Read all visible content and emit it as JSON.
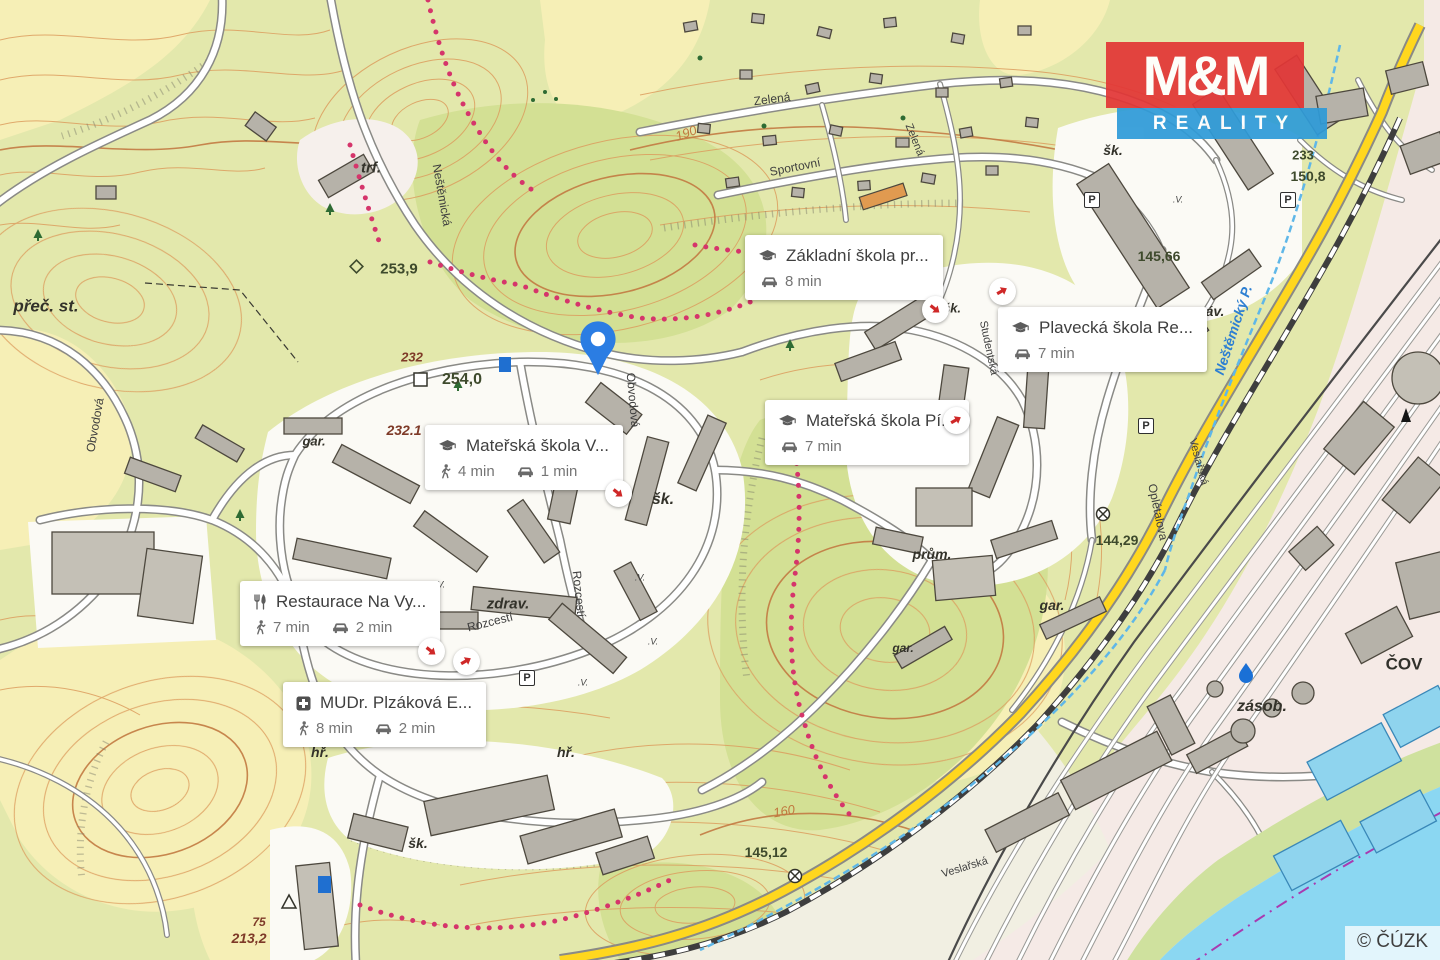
{
  "logo": {
    "title": "M&M",
    "subtitle": "REALITY"
  },
  "attribution": "© ČÚZK",
  "colors": {
    "pin": "#2b7de3",
    "logo_red": "#e23636",
    "logo_blue": "#2f9bd8",
    "route_arrow": "#cf2828",
    "water": "#8bd7f2",
    "main_road": "#ffd71e"
  },
  "pois": [
    {
      "id": "zakladni-skola",
      "icon": "graduation-cap-icon",
      "title": "Základní škola pr...",
      "drive": "8 min"
    },
    {
      "id": "plavecka-skola",
      "icon": "graduation-cap-icon",
      "title": "Plavecká škola Re...",
      "drive": "7 min"
    },
    {
      "id": "materska-skola-pi",
      "icon": "graduation-cap-icon",
      "title": "Mateřská škola Pí...",
      "drive": "7 min"
    },
    {
      "id": "materska-skola-v",
      "icon": "graduation-cap-icon",
      "title": "Mateřská škola V...",
      "walk": "4 min",
      "drive": "1 min"
    },
    {
      "id": "restaurace-na-vy",
      "icon": "restaurant-icon",
      "title": "Restaurace Na Vy...",
      "walk": "7 min",
      "drive": "2 min"
    },
    {
      "id": "mudr-plzakova",
      "icon": "medical-cross-icon",
      "title": "MUDr. Plzáková E...",
      "walk": "8 min",
      "drive": "2 min"
    }
  ],
  "route_arrows": [
    {
      "x": 935,
      "y": 309,
      "dir": "se"
    },
    {
      "x": 1002,
      "y": 291,
      "dir": "ne"
    },
    {
      "x": 956,
      "y": 420,
      "dir": "ne"
    },
    {
      "x": 618,
      "y": 493,
      "dir": "se"
    },
    {
      "x": 431,
      "y": 651,
      "dir": "se"
    },
    {
      "x": 466,
      "y": 661,
      "dir": "ne"
    }
  ],
  "map_labels": [
    {
      "text": "přeč. st.",
      "x": 46,
      "y": 306,
      "fs": 17,
      "cls": "spot",
      "rot": 0
    },
    {
      "text": "trf.",
      "x": 371,
      "y": 168,
      "fs": 15,
      "cls": "spot",
      "rot": 0
    },
    {
      "text": "253,9",
      "x": 399,
      "y": 269,
      "fs": 15,
      "cls": "height",
      "rot": 0
    },
    {
      "text": "232",
      "x": 412,
      "y": 357,
      "fs": 13,
      "cls": "heightred",
      "rot": 0
    },
    {
      "text": "254,0",
      "x": 462,
      "y": 380,
      "fs": 16,
      "cls": "height",
      "rot": 0
    },
    {
      "text": "232.1",
      "x": 404,
      "y": 430,
      "fs": 14,
      "cls": "heightred",
      "rot": 0
    },
    {
      "text": "gar.",
      "x": 314,
      "y": 441,
      "fs": 13,
      "cls": "spot",
      "rot": 0
    },
    {
      "text": "zdrav.",
      "x": 508,
      "y": 604,
      "fs": 15,
      "cls": "spot",
      "rot": 0
    },
    {
      "text": "šk.",
      "x": 663,
      "y": 500,
      "fs": 16,
      "cls": "spot",
      "rot": 0
    },
    {
      "text": "šk.",
      "x": 952,
      "y": 308,
      "fs": 13,
      "cls": "spot",
      "rot": 0
    },
    {
      "text": "šk.",
      "x": 1113,
      "y": 150,
      "fs": 14,
      "cls": "spot",
      "rot": 0
    },
    {
      "text": "šk.",
      "x": 418,
      "y": 843,
      "fs": 14,
      "cls": "spot",
      "rot": 0
    },
    {
      "text": "hř.",
      "x": 320,
      "y": 752,
      "fs": 14,
      "cls": "spot",
      "rot": 0
    },
    {
      "text": "hř.",
      "x": 566,
      "y": 752,
      "fs": 14,
      "cls": "spot",
      "rot": 0
    },
    {
      "text": "gar.",
      "x": 1052,
      "y": 605,
      "fs": 14,
      "cls": "spot",
      "rot": 0
    },
    {
      "text": "gar.",
      "x": 903,
      "y": 648,
      "fs": 12,
      "cls": "spot",
      "rot": 0
    },
    {
      "text": "prům.",
      "x": 932,
      "y": 554,
      "fs": 14,
      "cls": "spot",
      "rot": 0
    },
    {
      "text": "ČOV",
      "x": 1404,
      "y": 664,
      "fs": 17,
      "cls": "big",
      "rot": 0
    },
    {
      "text": "zásob.",
      "x": 1262,
      "y": 707,
      "fs": 16,
      "cls": "spot",
      "rot": 0
    },
    {
      "text": "145,66",
      "x": 1159,
      "y": 256,
      "fs": 14,
      "cls": "height",
      "rot": 0
    },
    {
      "text": "233",
      "x": 1303,
      "y": 155,
      "fs": 13,
      "cls": "height",
      "rot": 0
    },
    {
      "text": "150,8",
      "x": 1308,
      "y": 176,
      "fs": 14,
      "cls": "height",
      "rot": 0
    },
    {
      "text": "144,29",
      "x": 1117,
      "y": 540,
      "fs": 14,
      "cls": "height",
      "rot": 0
    },
    {
      "text": "145,12",
      "x": 766,
      "y": 852,
      "fs": 14,
      "cls": "height",
      "rot": 0
    },
    {
      "text": "160",
      "x": 784,
      "y": 811,
      "fs": 13,
      "cls": "contour",
      "rot": -10
    },
    {
      "text": "190",
      "x": 686,
      "y": 133,
      "fs": 13,
      "cls": "contour",
      "rot": -20
    },
    {
      "text": "75",
      "x": 259,
      "y": 922,
      "fs": 12,
      "cls": "heightred",
      "rot": 0
    },
    {
      "text": "213,2",
      "x": 249,
      "y": 938,
      "fs": 14,
      "cls": "heightred",
      "rot": 0
    },
    {
      "text": "Neštěmická",
      "x": 442,
      "y": 195,
      "fs": 12,
      "cls": "street",
      "rot": 80
    },
    {
      "text": "Obvodová",
      "x": 633,
      "y": 400,
      "fs": 12,
      "cls": "street",
      "rot": 85
    },
    {
      "text": "Obvodová",
      "x": 95,
      "y": 425,
      "fs": 12,
      "cls": "street",
      "rot": -80
    },
    {
      "text": "Rozcestí",
      "x": 490,
      "y": 622,
      "fs": 12,
      "cls": "street",
      "rot": -14
    },
    {
      "text": "Rozcestí",
      "x": 579,
      "y": 594,
      "fs": 12,
      "cls": "street",
      "rot": 84
    },
    {
      "text": "Zelená",
      "x": 772,
      "y": 99,
      "fs": 12,
      "cls": "street",
      "rot": -7
    },
    {
      "text": "Sportovní",
      "x": 795,
      "y": 167,
      "fs": 12,
      "cls": "street",
      "rot": -11
    },
    {
      "text": "Zelená",
      "x": 914,
      "y": 140,
      "fs": 11,
      "cls": "street",
      "rot": 68
    },
    {
      "text": "Studentská",
      "x": 988,
      "y": 348,
      "fs": 11,
      "cls": "street",
      "rot": 78
    },
    {
      "text": "Oplétalova",
      "x": 1158,
      "y": 512,
      "fs": 12,
      "cls": "street",
      "rot": 78
    },
    {
      "text": "Veslařská",
      "x": 1198,
      "y": 462,
      "fs": 11,
      "cls": "street",
      "rot": 75
    },
    {
      "text": "Veslařská",
      "x": 965,
      "y": 868,
      "fs": 11,
      "cls": "street",
      "rot": -17
    },
    {
      "text": "práv.",
      "x": 1208,
      "y": 311,
      "fs": 14,
      "cls": "spot",
      "rot": 0
    },
    {
      "text": "Neštěmický P.",
      "x": 1233,
      "y": 330,
      "fs": 14,
      "cls": "water",
      "rot": -72
    },
    {
      "text": "P",
      "x": 1092,
      "y": 200,
      "fs": 11,
      "cls": "parking",
      "rot": 0
    },
    {
      "text": "P",
      "x": 1288,
      "y": 200,
      "fs": 11,
      "cls": "parking",
      "rot": 0
    },
    {
      "text": "P",
      "x": 1146,
      "y": 426,
      "fs": 11,
      "cls": "parking",
      "rot": 0
    },
    {
      "text": "P",
      "x": 527,
      "y": 678,
      "fs": 11,
      "cls": "parking",
      "rot": 0
    },
    {
      "text": ".V.",
      "x": 440,
      "y": 585,
      "fs": 9,
      "cls": "tiny",
      "rot": 0
    },
    {
      "text": ".V.",
      "x": 640,
      "y": 578,
      "fs": 9,
      "cls": "tiny",
      "rot": 0
    },
    {
      "text": ".V.",
      "x": 653,
      "y": 642,
      "fs": 9,
      "cls": "tiny",
      "rot": 0
    },
    {
      "text": ".V.",
      "x": 583,
      "y": 683,
      "fs": 9,
      "cls": "tiny",
      "rot": 0
    },
    {
      "text": ".V.",
      "x": 1178,
      "y": 200,
      "fs": 9,
      "cls": "tiny",
      "rot": 0
    }
  ]
}
